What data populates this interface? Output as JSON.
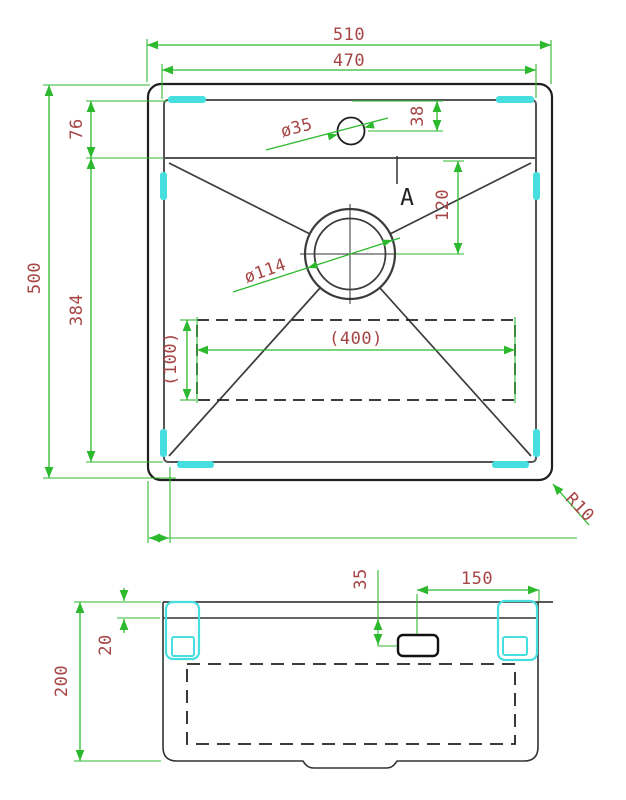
{
  "drawing": {
    "top_view": {
      "outer_width": "510",
      "basin_width": "470",
      "outer_depth": "500",
      "deck_depth": "76",
      "basin_depth": "384",
      "faucet_hole_offset": "38",
      "faucet_hole_diameter": "ø35",
      "drain_offset": "120",
      "drain_diameter": "ø114",
      "base_pad_width": "(400)",
      "base_pad_depth": "(100)",
      "corner_radius": "R10",
      "section_marker": "A"
    },
    "side_view": {
      "overall_height": "200",
      "rim_height": "20",
      "overflow_offset": "35",
      "overflow_to_edge": "150"
    },
    "colors": {
      "dimension_line": "#2db92d",
      "dimension_text": "#a64545",
      "clip_highlight": "#46dede",
      "outline": "#222222"
    }
  }
}
